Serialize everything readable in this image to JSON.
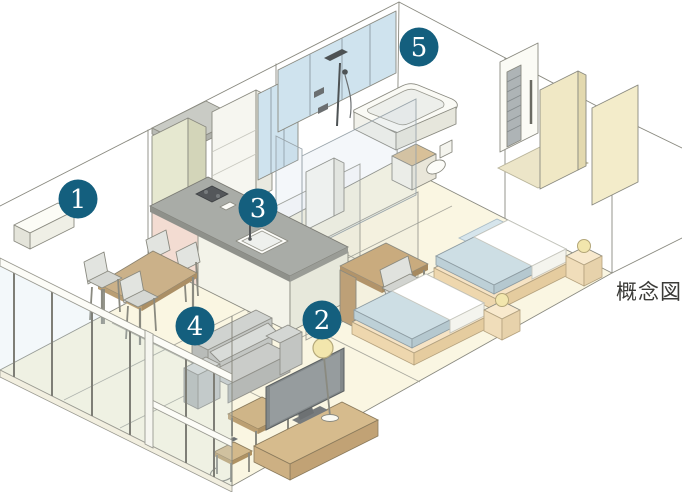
{
  "diagram": {
    "caption": "概念図",
    "badges": [
      {
        "number": "1",
        "x": 78,
        "y": 199
      },
      {
        "number": "2",
        "x": 322,
        "y": 320
      },
      {
        "number": "3",
        "x": 258,
        "y": 208
      },
      {
        "number": "4",
        "x": 195,
        "y": 326
      },
      {
        "number": "5",
        "x": 419,
        "y": 47
      }
    ],
    "colors": {
      "badge": "#145f7e",
      "badge_text": "#ffffff",
      "caption_text": "#3b3b38",
      "floor": "#faf6e2",
      "line": "#8a8a80",
      "glass": "#cfe3ee",
      "wood": "#cbb189",
      "bed_platform": "#f6e3c4",
      "mattress": "#cddee4",
      "duvet": "#ffffff",
      "sofa": "#c6c9c6",
      "lamp_shade": "#f2e6ad",
      "counter": "#a9aca7",
      "cabinet_sage": "#e6e8d0",
      "accent_pink": "#f3dcd2",
      "entry_beige": "#f0e8c5"
    }
  }
}
